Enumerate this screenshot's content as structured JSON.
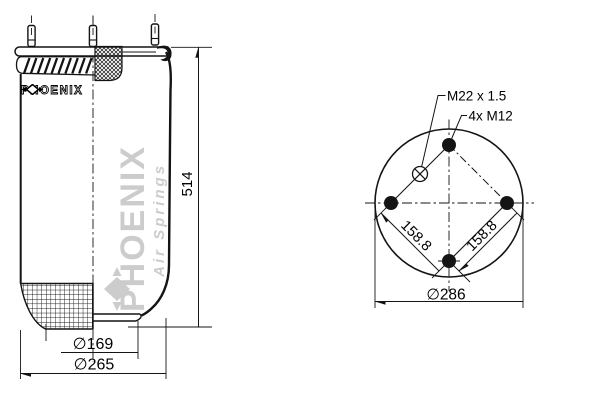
{
  "side_view": {
    "height_dim": "514",
    "piston_diameter_dim": "∅169",
    "bellows_diameter_dim": "∅265",
    "brand_label": "PHOENIX"
  },
  "top_view": {
    "air_fitting_label": "M22 x 1.5",
    "bolts_label": "4x M12",
    "bolt_spacing_left": "158.8",
    "bolt_spacing_right": "158.8",
    "bolt_circle_dim": "∅286"
  },
  "watermark": {
    "brand": "PHOENIX",
    "tagline": "Air Springs"
  },
  "colors": {
    "line": "#141414",
    "watermark": "#cccccc",
    "background": "#ffffff"
  }
}
